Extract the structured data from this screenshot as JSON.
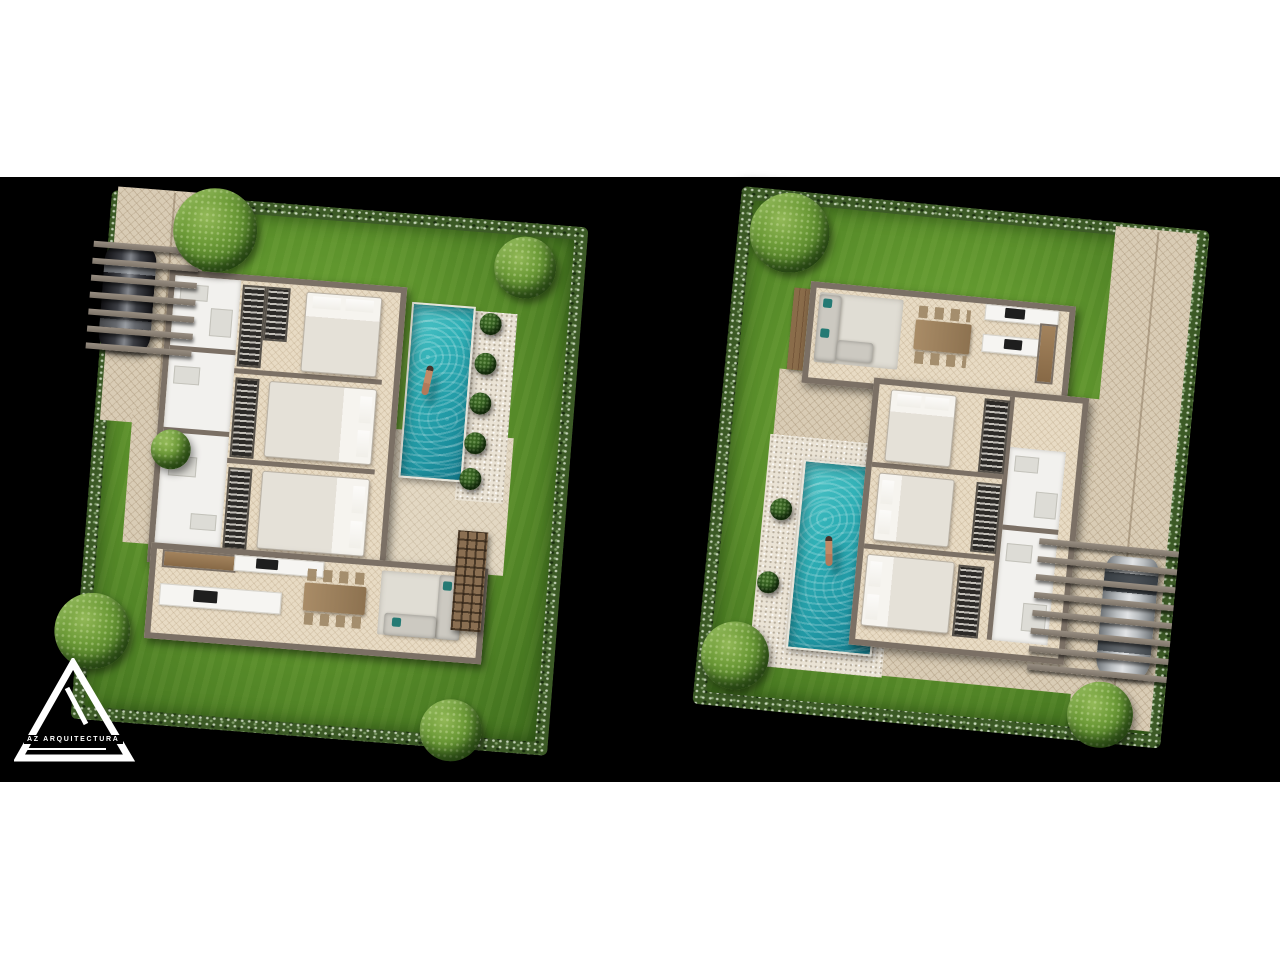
{
  "page": {
    "background": "#ffffff",
    "stage_background": "#000000"
  },
  "logo": {
    "brand": "AZ ARQUITECTURA"
  },
  "palette": {
    "lawn": "#5f9630",
    "hedge": "#3c5a26",
    "paving": "#d9ccb5",
    "terrace": "#e3d8c3",
    "gravel": "#eae3d5",
    "wall": "#7b7065",
    "wood_floor": "#e8dbc4",
    "white_room": "#f2f1ee",
    "pool_water": "#2fb0b6",
    "pool_deep": "#147d8e",
    "tree_foliage": "#4f7d26",
    "bush": "#28511a",
    "car_dark": "#26272b",
    "car_silver": "#c6cacd",
    "sofa": "#ccc9c1",
    "cushion_teal": "#257a74",
    "table_wood": "#9c7e58",
    "wardrobe": "#2c2a27",
    "pergola": "#8a8076"
  },
  "plans": [
    {
      "id": "left",
      "name": "villa-site-plan-a",
      "elements": {
        "bedrooms": 3,
        "bathrooms": 3,
        "pool_side": "right",
        "driveway_side": "left",
        "car": "dark",
        "pool_bushes": 5,
        "trees": 5,
        "pergola_slats": 7,
        "rooms": [
          "bathroom",
          "laundry",
          "bathroom",
          "bedroom",
          "bedroom",
          "bedroom",
          "kitchen",
          "dining",
          "living"
        ]
      }
    },
    {
      "id": "right",
      "name": "villa-site-plan-b",
      "elements": {
        "bedrooms": 3,
        "bathrooms": 2,
        "pool_side": "left",
        "driveway_side": "right",
        "car": "silver",
        "pool_bushes": 2,
        "trees": 3,
        "pergola_slats": 8,
        "rooms": [
          "living",
          "dining",
          "kitchen",
          "bedroom",
          "bedroom",
          "bedroom",
          "bathroom",
          "bathroom"
        ]
      }
    }
  ]
}
